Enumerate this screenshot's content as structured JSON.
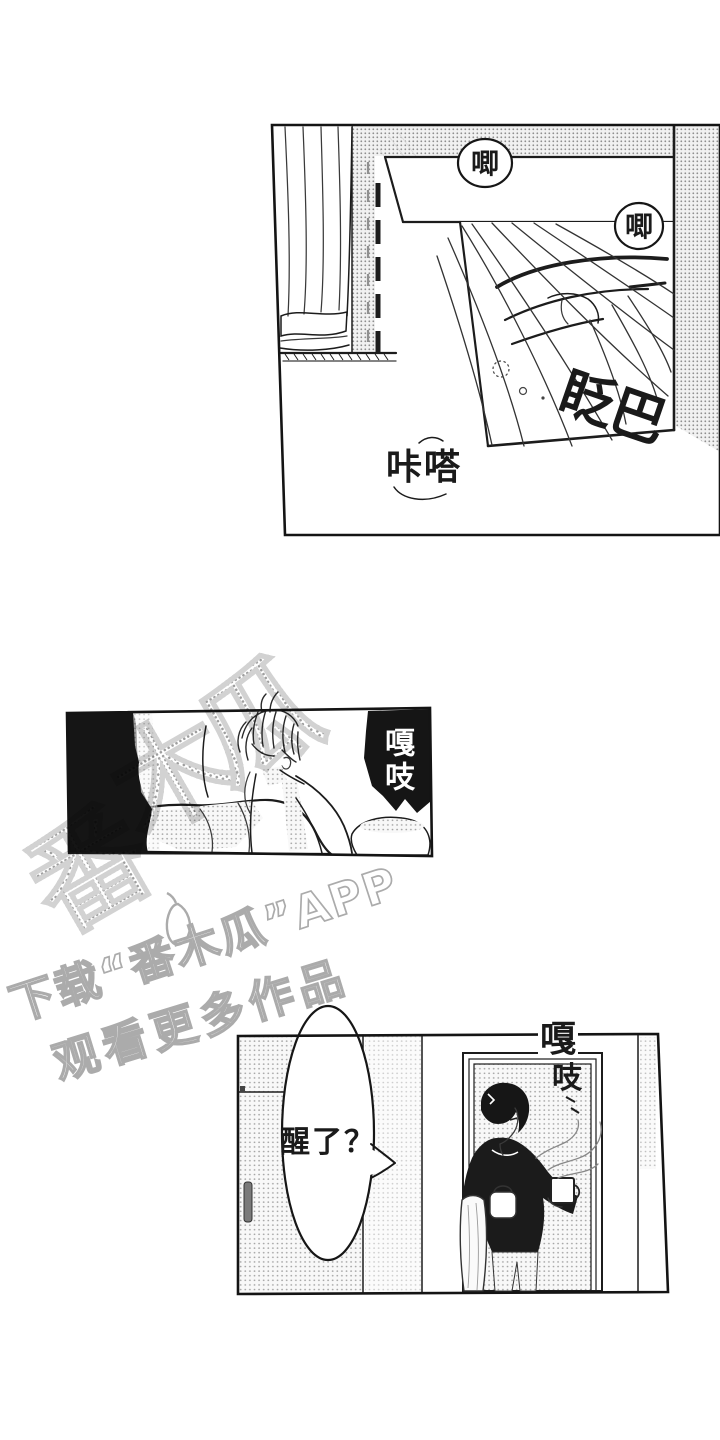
{
  "page": {
    "background": "#ffffff",
    "ink_color": "#1a1a1a",
    "halftone_color": "#9a9a9a"
  },
  "panel_1": {
    "description": "window curtain and eye close-up inset",
    "bubble_1": "唧",
    "bubble_2": "唧",
    "sfx_blink": "眨巴",
    "sfx_click": "咔嗒"
  },
  "panel_2": {
    "description": "boy sitting up in bed",
    "sfx_creak": "嘎吱"
  },
  "panel_3": {
    "description": "man in doorway holding steaming mug",
    "sfx_creak_top": "嘎",
    "sfx_creak_bottom": "吱",
    "speech_bubble": "醒了？"
  },
  "watermark": {
    "logo_char_1": "番",
    "logo_char_2": "木",
    "logo_char_3": "瓜",
    "caption_line_1": "下载“番木瓜”APP",
    "caption_line_2": "观看更多作品",
    "color": "#a6a6a6"
  }
}
